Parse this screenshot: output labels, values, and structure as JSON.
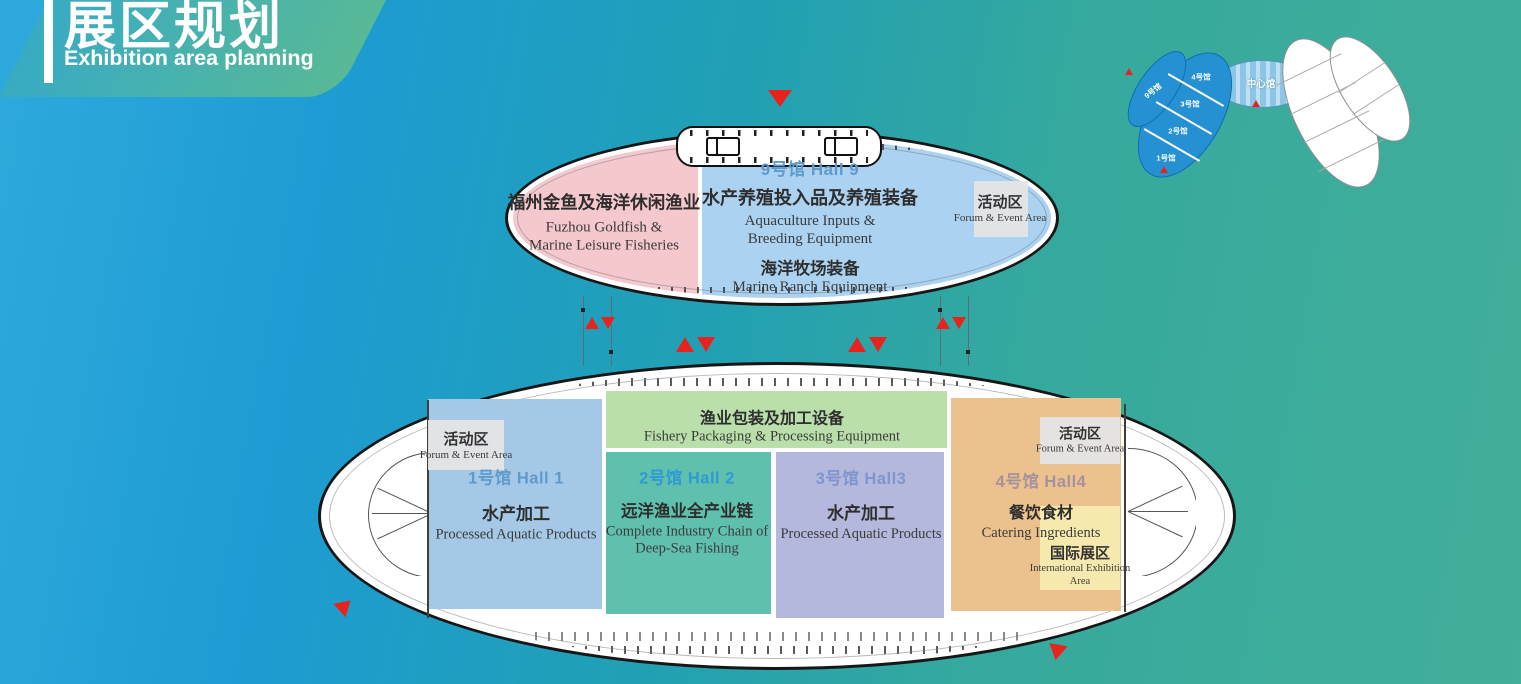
{
  "header": {
    "title_zh": "展区规划",
    "title_en": "Exhibition area planning"
  },
  "minimap": {
    "hall9": "9号馆",
    "hall4": "4号馆",
    "hall3": "3号馆",
    "hall2": "2号馆",
    "hall1": "1号馆",
    "center": "中心馆"
  },
  "upper": {
    "hall9_label": "9号馆 Hall 9",
    "pink_zh": "福州金鱼及海洋休闲渔业",
    "pink_en1": "Fuzhou Goldfish &",
    "pink_en2": "Marine Leisure Fisheries",
    "aqua_zh": "水产养殖投入品及养殖装备",
    "aqua_en1": "Aquaculture Inputs &",
    "aqua_en2": "Breeding Equipment",
    "ranch_zh": "海洋牧场装备",
    "ranch_en": "Marine Ranch Equipment",
    "event_zh": "活动区",
    "event_en": "Forum & Event Area"
  },
  "lower": {
    "event_zh": "活动区",
    "event_en": "Forum & Event Area",
    "hall1_label": "1号馆 Hall 1",
    "hall1_zh": "水产加工",
    "hall1_en": "Processed Aquatic Products",
    "band_zh": "渔业包装及加工设备",
    "band_en": "Fishery Packaging & Processing Equipment",
    "hall2_label": "2号馆 Hall 2",
    "hall2_zh": "远洋渔业全产业链",
    "hall2_en1": "Complete Industry Chain of",
    "hall2_en2": "Deep-Sea Fishing",
    "hall3_label": "3号馆 Hall3",
    "hall3_zh": "水产加工",
    "hall3_en": "Processed Aquatic Products",
    "hall4_label": "4号馆 Hall4",
    "hall4_zh": "餐饮食材",
    "hall4_en": "Catering Ingredients",
    "intl_zh": "国际展区",
    "intl_en1": "International Exhibition",
    "intl_en2": "Area"
  },
  "colors": {
    "bg_blue": "#1d9cd3",
    "bg_green": "#43ae99",
    "accent_red": "#e8231d",
    "pink": "#f4c8cc",
    "hall9_blue": "#abd2f0",
    "hall1_blue": "#a4c8e6",
    "band_green": "#badfab",
    "hall2_teal": "#5fc0ae",
    "hall3_purple": "#b4b8dd",
    "hall4_orange": "#ebc28d",
    "intl_yellow": "#f6e9ae",
    "event_gray": "#e4e4e4",
    "label_blue": "#5e9bcd",
    "label_blue2": "#2f99d4",
    "label_purple": "#8094ce",
    "label_mauve": "#a5929e",
    "minimap_blue": "#2590d2",
    "minimap_center": "#8cc6e6"
  }
}
